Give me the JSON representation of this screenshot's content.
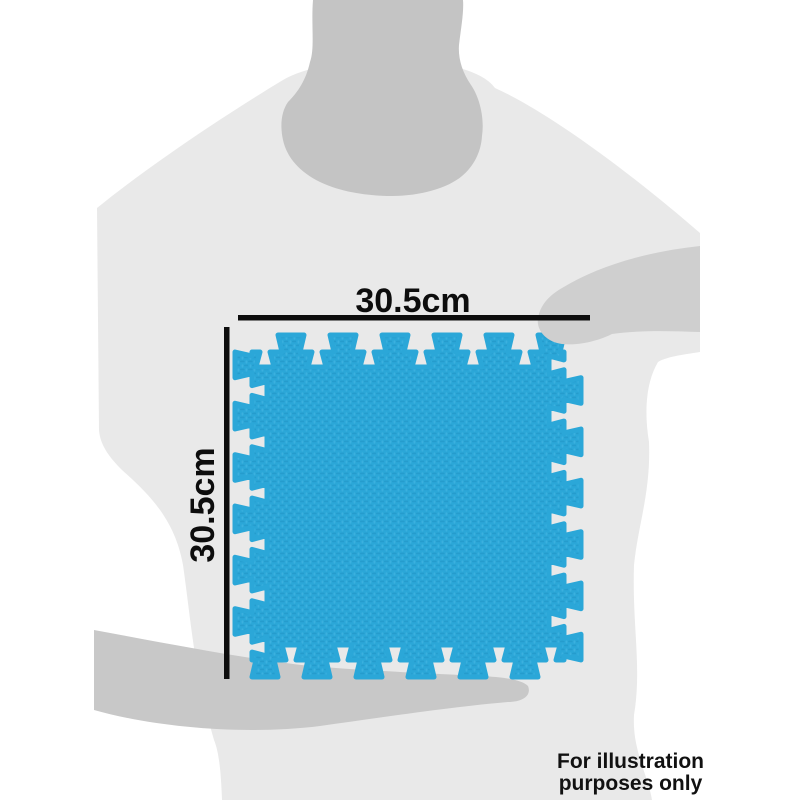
{
  "dimension_labels": {
    "width": "30.5cm",
    "height": "30.5cm"
  },
  "disclaimer": {
    "line1": "For illustration",
    "line2": "purposes only"
  },
  "colors": {
    "background": "#ffffff",
    "silhouette_light": "#e9e9e9",
    "silhouette_mid": "#c4c4c4",
    "silhouette_arm": "#c8c8c8",
    "silhouette_arm_right": "#cfcfcf",
    "mat_blue": "#2ba7d8",
    "mat_blue_dark": "#2194c5",
    "mat_blue_light": "#46b5e3",
    "dimension_line": "#0d0d0d",
    "disclaimer_text": "#111111"
  }
}
